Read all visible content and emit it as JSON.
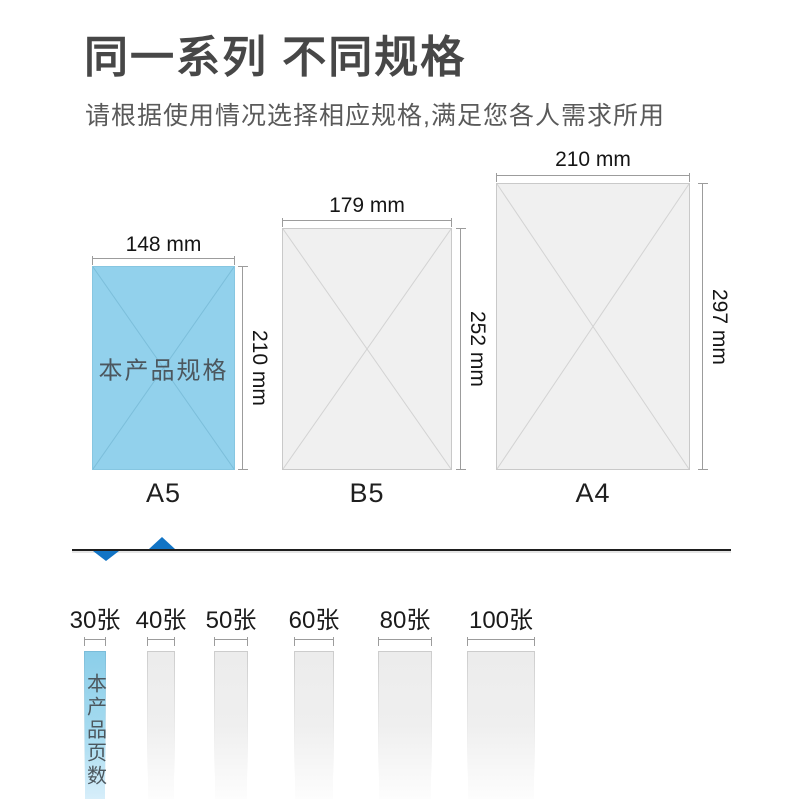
{
  "header": {
    "title": "同一系列 不同规格",
    "subtitle": "请根据使用情况选择相应规格,满足您各人需求所用"
  },
  "sizes": {
    "items": [
      {
        "label": "A5",
        "width_label": "148 mm",
        "height_label": "210 mm",
        "tag": "本产品规格",
        "highlighted": true
      },
      {
        "label": "B5",
        "width_label": "179 mm",
        "height_label": "252 mm",
        "tag": "",
        "highlighted": false
      },
      {
        "label": "A4",
        "width_label": "210 mm",
        "height_label": "297 mm",
        "tag": "",
        "highlighted": false
      }
    ]
  },
  "pages": {
    "items": [
      {
        "label": "30张",
        "tag": "本产品页数",
        "highlighted": true
      },
      {
        "label": "40张",
        "tag": "",
        "highlighted": false
      },
      {
        "label": "50张",
        "tag": "",
        "highlighted": false
      },
      {
        "label": "60张",
        "tag": "",
        "highlighted": false
      },
      {
        "label": "80张",
        "tag": "",
        "highlighted": false
      },
      {
        "label": "100张",
        "tag": "",
        "highlighted": false
      }
    ]
  },
  "colors": {
    "accent_blue": "#1274c5",
    "paper_blue": "#92d1ec",
    "paper_gray": "#f0f0f0",
    "text_dark": "#474747",
    "dim_line": "#9c9c9c"
  }
}
